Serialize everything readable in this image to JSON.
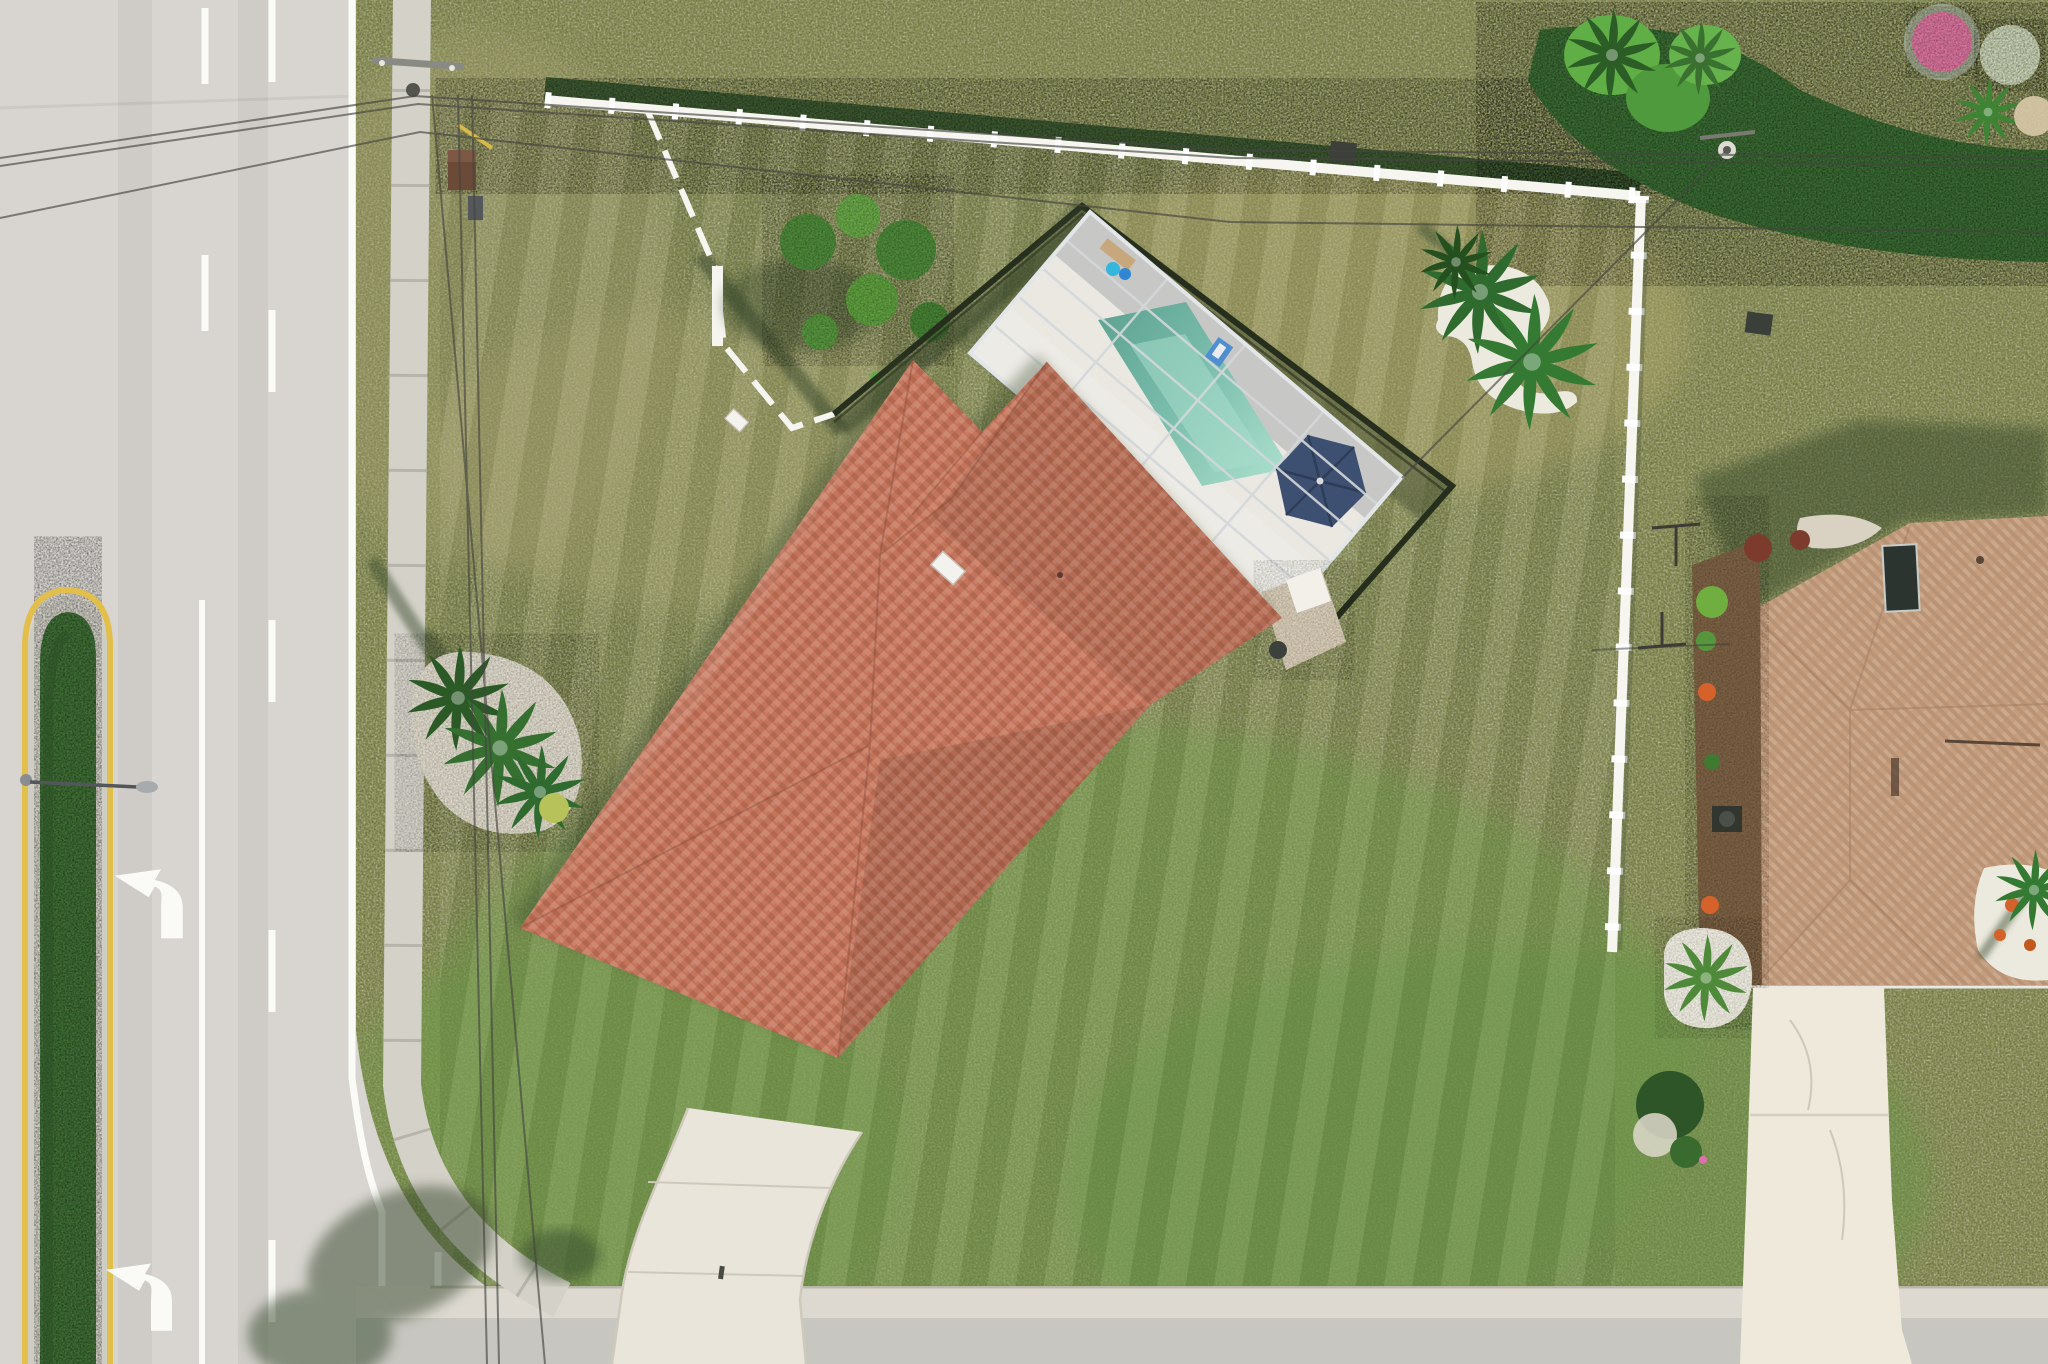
{
  "image_type": "aerial-drone-photograph",
  "scene": {
    "description": "Top-down aerial view of a single-family Florida home with orange tile roof, screened pool enclosure with teal pool and navy umbrella, large olive lawn, curved concrete driveway, multi-lane road with hedge median and left-turn arrows on the left, white PVC fences, palm landscaping islands, and a tan-roofed neighboring house with its own driveway on the right",
    "objects": [
      "road",
      "median-hedge",
      "left-turn-arrows",
      "street-light",
      "sidewalk",
      "utility-pole",
      "power-lines",
      "main-lawn",
      "white-fence",
      "stepped-side-fence",
      "shrub-cluster",
      "palm-island-left",
      "palm-island-right",
      "pool-screen-enclosure",
      "pool",
      "pool-deck",
      "patio-umbrella",
      "lounge-bench",
      "pool-floats",
      "deck-chair",
      "main-house-tile-roof",
      "skylights",
      "curved-driveway",
      "paver-patio",
      "neighbor-house-roof",
      "neighbor-driveway",
      "mulch-garden-bed",
      "ac-unit",
      "gravel-planting-beds",
      "clothesline-poles",
      "tropical-hedge-row",
      "flower-bushes",
      "bottom-street"
    ]
  },
  "colors": {
    "road": "#d8d5d0",
    "sidewalk": "#d4d1c8",
    "asphalt": "#c8c6c1",
    "gutter": "#ddd9d1",
    "grass": "#8b9156",
    "grass_green": "#6f9a48",
    "straw": "#b3a96e",
    "hedge": "#3f6f35",
    "marking_white": "#fafaf7",
    "marking_yellow": "#e2bf4a",
    "fence": "#f6f5f0",
    "mesh": "#262f1e",
    "shadow": "#34452a",
    "roof": "#c4745a",
    "neighbor_roof": "#c69e7e",
    "deck": "#eae8e1",
    "frame": "#d3d7da",
    "pool": "#7abcaa",
    "pool_light": "#a7ddcb",
    "umbrella": "#3e5071",
    "drive": "#e9e5da",
    "neighbor_drive": "#efe9dc",
    "gravel": "#ece9de",
    "mulch": "#7c6144",
    "palm": "#2f6b2f",
    "palm_light": "#53944a",
    "bush": "#4e8a3a",
    "flower_pink": "#d9739c",
    "flower_orange": "#d4622a",
    "wire": "#454540",
    "transformer": "#6b4a38"
  }
}
